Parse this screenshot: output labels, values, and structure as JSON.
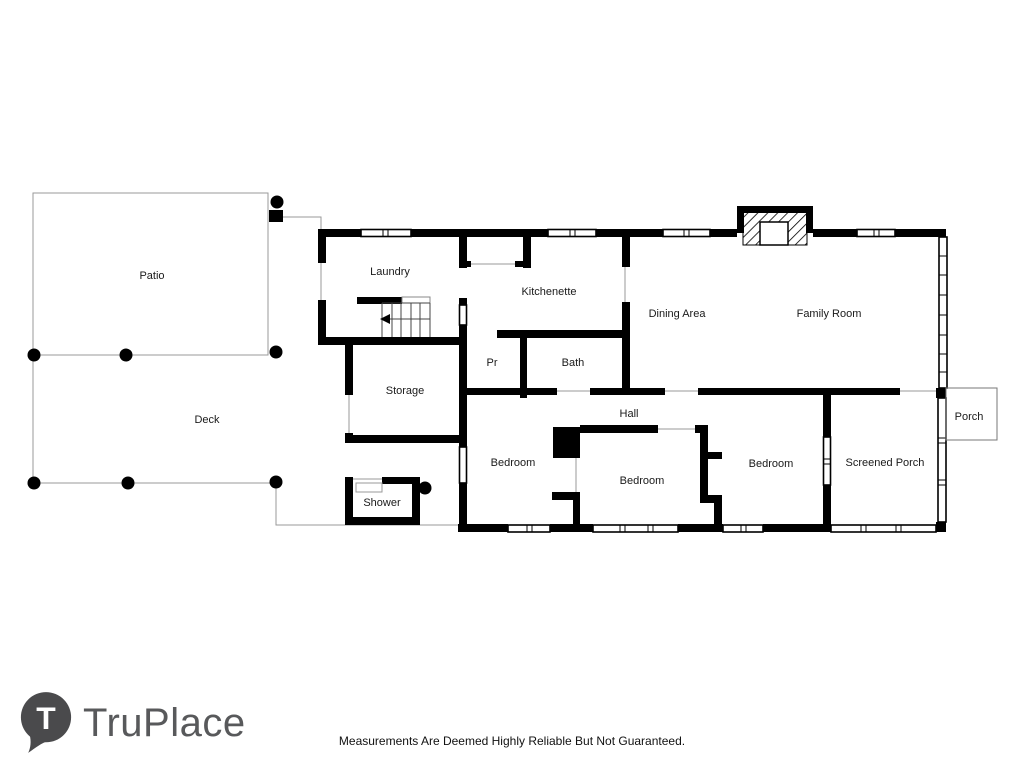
{
  "branding": {
    "logo_letter": "T",
    "logo_text": "TruPlace"
  },
  "footer": {
    "disclaimer": "Measurements Are Deemed Highly Reliable But Not Guaranteed."
  },
  "colors": {
    "wall": "#000000",
    "thin_line": "#999999",
    "label": "#1a1a1a",
    "logo_gray": "#58595b",
    "logo_pin": "#4a4a4c"
  },
  "rooms": {
    "patio": {
      "label": "Patio"
    },
    "deck": {
      "label": "Deck"
    },
    "laundry": {
      "label": "Laundry"
    },
    "kitchenette": {
      "label": "Kitchenette"
    },
    "dining_area": {
      "label": "Dining Area"
    },
    "family_room": {
      "label": "Family Room"
    },
    "storage": {
      "label": "Storage"
    },
    "powder_room": {
      "label": "Pr"
    },
    "bath": {
      "label": "Bath"
    },
    "hall": {
      "label": "Hall"
    },
    "bedroom_left": {
      "label": "Bedroom"
    },
    "bedroom_middle": {
      "label": "Bedroom"
    },
    "bedroom_right": {
      "label": "Bedroom"
    },
    "screened_porch": {
      "label": "Screened Porch"
    },
    "porch": {
      "label": "Porch"
    },
    "shower": {
      "label": "Shower"
    }
  }
}
